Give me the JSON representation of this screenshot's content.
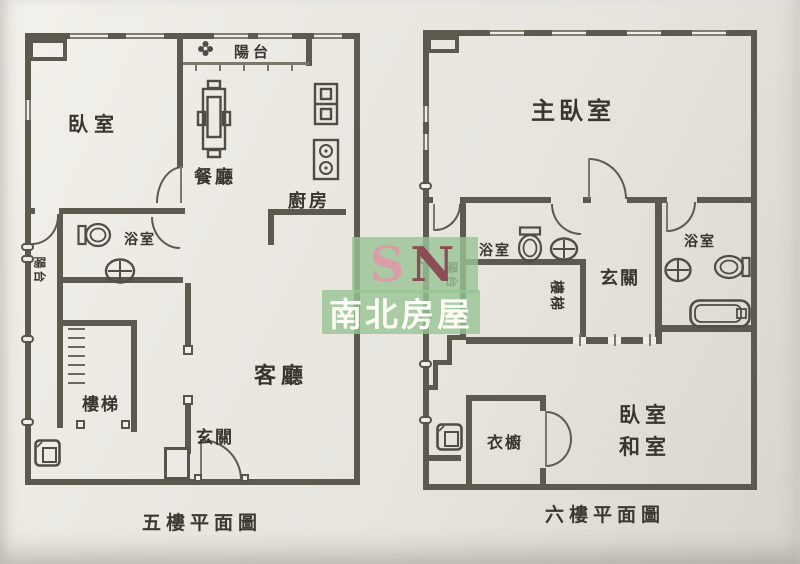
{
  "floor5": {
    "caption": "五樓平面圖",
    "rooms": {
      "bedroom": "臥室",
      "balcony_top": "陽台",
      "dining": "餐廳",
      "kitchen": "廚房",
      "bathroom": "浴室",
      "balcony_left": "陽台",
      "stairs": "樓梯",
      "living": "客廳",
      "entry": "玄關"
    }
  },
  "floor6": {
    "caption": "六樓平面圖",
    "rooms": {
      "master_bedroom": "主臥室",
      "bathroom_left": "浴室",
      "bathroom_right": "浴室",
      "stairs": "樓梯",
      "entry": "玄關",
      "balcony_left": "陽台",
      "closet": "衣櫥",
      "bedroom_line1": "臥室",
      "bedroom_line2": "和室"
    }
  },
  "watermark": {
    "letter_s": "S",
    "letter_n": "N",
    "brand": "南北房屋"
  },
  "colors": {
    "wall": "#5c594f",
    "paper": "#e9e6e0",
    "ink": "#38362e",
    "watermark_green": "#97c493",
    "watermark_s": "#dd9aa6",
    "watermark_n": "#8b4250"
  }
}
